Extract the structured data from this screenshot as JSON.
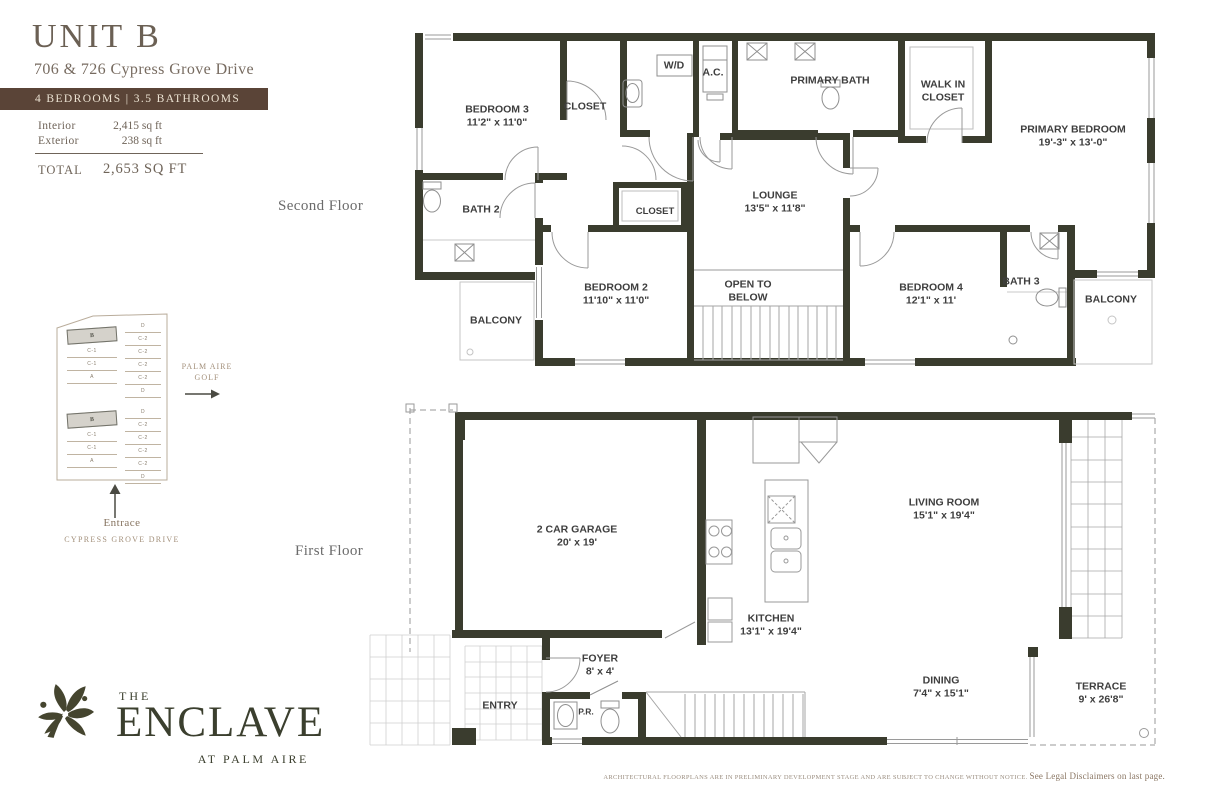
{
  "header": {
    "unit_title": "UNIT B",
    "address": "706 & 726 Cypress Grove Drive",
    "banner": "4 BEDROOMS  |  3.5 BATHROOMS",
    "interior_label": "Interior",
    "interior_value": "2,415 sq ft",
    "exterior_label": "Exterior",
    "exterior_value": "238 sq ft",
    "total_label": "TOTAL",
    "total_value": "2,653 SQ FT"
  },
  "floor_labels": {
    "second": "Second Floor",
    "first": "First Floor"
  },
  "second_floor": {
    "bedroom3": {
      "name": "BEDROOM 3",
      "dims": "11'2\" x 11'0\""
    },
    "closet_top": {
      "name": "CLOSET"
    },
    "wd": {
      "name": "W/D"
    },
    "ac": {
      "name": "A.C."
    },
    "primary_bath": {
      "name": "PRIMARY BATH"
    },
    "walk_in_closet": {
      "name": "WALK IN CLOSET"
    },
    "primary_bedroom": {
      "name": "PRIMARY BEDROOM",
      "dims": "19'-3\" x 13'-0\""
    },
    "bath2": {
      "name": "BATH 2"
    },
    "closet_mid": {
      "name": "CLOSET"
    },
    "lounge": {
      "name": "LOUNGE",
      "dims": "13'5\" x 11'8\""
    },
    "bedroom2": {
      "name": "BEDROOM 2",
      "dims": "11'10\" x 11'0\""
    },
    "open_to_below": {
      "name": "OPEN TO BELOW"
    },
    "bedroom4": {
      "name": "BEDROOM 4",
      "dims": "12'1\" x 11'"
    },
    "bath3": {
      "name": "BATH 3"
    },
    "balcony_left": {
      "name": "BALCONY"
    },
    "balcony_right": {
      "name": "BALCONY"
    }
  },
  "first_floor": {
    "garage": {
      "name": "2 CAR GARAGE",
      "dims": "20' x 19'"
    },
    "living_room": {
      "name": "LIVING ROOM",
      "dims": "15'1\" x 19'4\""
    },
    "kitchen": {
      "name": "KITCHEN",
      "dims": "13'1\" x 19'4\""
    },
    "foyer": {
      "name": "FOYER",
      "dims": "8' x 4'"
    },
    "entry": {
      "name": "ENTRY"
    },
    "powder_room": {
      "name": "P.R."
    },
    "dining": {
      "name": "DINING",
      "dims": "7'4\" x 15'1\""
    },
    "terrace": {
      "name": "TERRACE",
      "dims": "9' x 26'8\""
    }
  },
  "site_map": {
    "golf_label_line1": "PALM AIRE",
    "golf_label_line2": "GOLF",
    "entrance_label": "Entrace",
    "street_label": "CYPRESS GROVE DRIVE",
    "cluster_top_left": [
      "B",
      "C-1",
      "C-1",
      "A"
    ],
    "cluster_bottom_left": [
      "B",
      "C-1",
      "C-1",
      "A"
    ],
    "cluster_top_right": [
      "D",
      "C-2",
      "C-2",
      "C-2",
      "C-2",
      "D"
    ],
    "cluster_bottom_right": [
      "D",
      "C-2",
      "C-2",
      "C-2",
      "C-2",
      "D"
    ]
  },
  "logo": {
    "word_the": "THE",
    "word_name": "ENCLAVE",
    "word_tagline": "AT PALM AIRE"
  },
  "disclaimer": {
    "small": "ARCHITECTURAL FLOORPLANS ARE IN PRELIMINARY DEVELOPMENT STAGE AND ARE SUBJECT TO CHANGE WITHOUT NOTICE. ",
    "emphasis": "See Legal Disclaimers on last page."
  },
  "colors": {
    "wall": "#3a3c2e",
    "banner": "#5a4437",
    "title": "#6b6054",
    "logo": "#3b3f2e"
  }
}
